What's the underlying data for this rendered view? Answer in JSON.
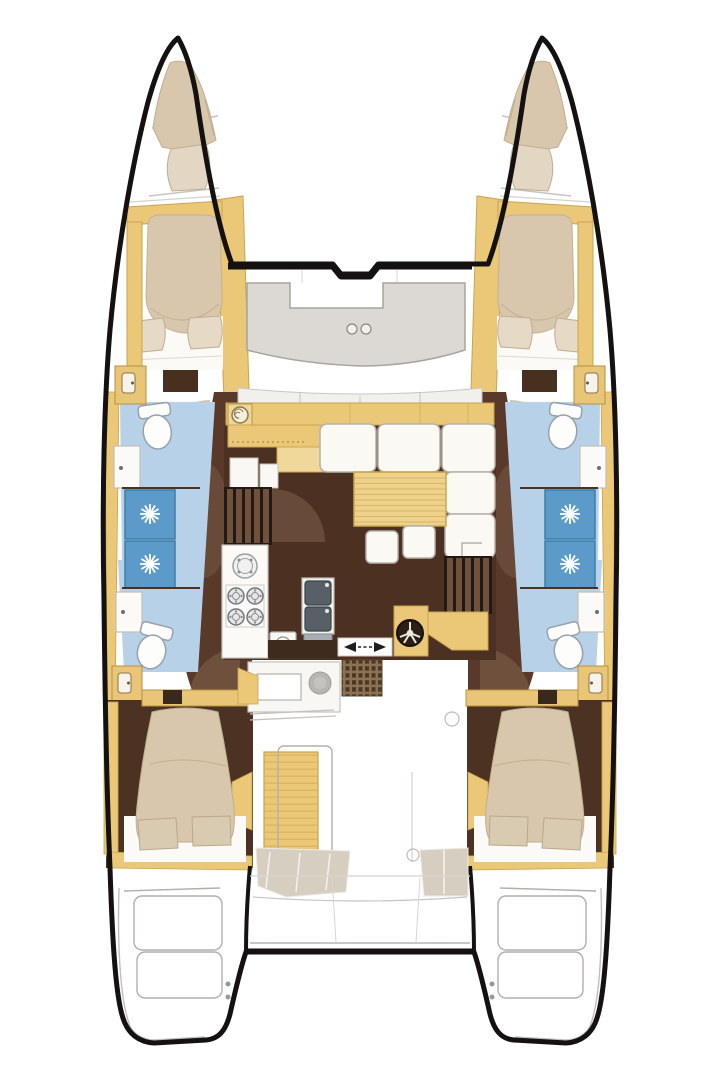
{
  "document": {
    "title": "Catamaran accommodation floor plan (top view)",
    "type": "floor-plan",
    "visible_text": []
  },
  "palette": {
    "background": "#ffffff",
    "hull_outline": "#141110",
    "deck_tan": "#eac878",
    "deck_tan_light": "#f0d79a",
    "tan_border": "#c9a44f",
    "saloon_floor_brown": "#4c3122",
    "corridor_brown": "#58392a",
    "shade_brown": "#9a7b5f",
    "mattress_beige": "#d8c7ad",
    "pillow_beige": "#e6dac7",
    "sheet_white": "#fbfaf6",
    "bathroom_floor_blue": "#b7d2e8",
    "shower_tile_blue": "#5c9ac9",
    "shower_tile_border": "#3c7cab",
    "fixture_white": "#fbfaf7",
    "fixture_outline": "#98a0aa",
    "sofa_white": "#fbf9f4",
    "sofa_outline": "#b6b2aa",
    "bench_gray": "#dcd8d3",
    "exterior_line_gray": "#b2aeaa",
    "sink_steel": "#566066",
    "mat_brown": "#8a7355",
    "mat_square_brown": "#4e3722",
    "step_dark": "#241812",
    "step_slat": "#6e523e"
  },
  "labels": {
    "plan": "Catamaran deck and accommodation plan",
    "port_hull": "Port hull accommodations",
    "starboard_hull": "Starboard hull accommodations (mirrored)",
    "forepeak_berth": "Forepeak crew berth",
    "bow_deck_band": "Foredeck band over hull",
    "forward_cabin": "Forward double cabin",
    "forward_head": "Forward head (toilet and vanity)",
    "shower": "Shower with drain",
    "aft_head": "Aft head (toilet and vanity)",
    "wardrobe": "Locker with door",
    "corridor": "Hull companionway corridor",
    "aft_cabin": "Aft double cabin",
    "swim_platform": "Transom swim platform steps",
    "trampoline_beam": "Forward crossbeam",
    "aft_beam": "Aft crossbeam",
    "foredeck_bench": "Forward cockpit U-bench",
    "cup_holders": "Cup holders",
    "window_band": "Saloon forward window",
    "coachroof_band": "Coachroof front cabinet",
    "saloon": "Saloon",
    "galley": "Galley",
    "corner_sink": "Round corner basin",
    "fridge": "Galley refrigerator tops",
    "steps_port": "Companionway steps to port hull",
    "steps_starboard": "Companionway steps to starboard hull",
    "round_sink": "Round galley sink",
    "stove": "Four-burner stove",
    "oven": "Small appliance",
    "double_sink": "Double stainless sink",
    "worktop": "Worktop",
    "sofa": "Saloon L-shaped sofa",
    "table": "Saloon table",
    "stools": "Movable stools",
    "sliding_door": "Sliding door to cockpit",
    "helm": "Helm wheel station",
    "companionway_mat": "Cockpit tread mat",
    "cockpit": "Aft cockpit",
    "wet_bar": "Cockpit wet bar / sink unit",
    "cockpit_table": "Cockpit table and bench",
    "aft_bench": "Aft cockpit bench seats",
    "davits": "Davit and transom structure",
    "toilet": "Marine toilet",
    "vanity": "Vanity basin"
  }
}
